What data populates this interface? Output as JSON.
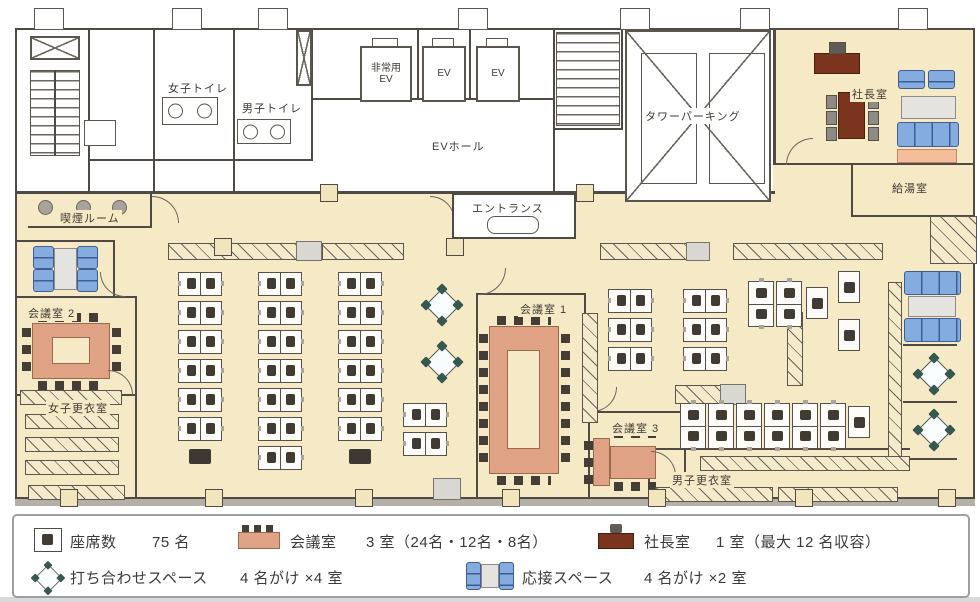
{
  "rooms": {
    "womens_toilet": "女子トイレ",
    "mens_toilet": "男子トイレ",
    "emergency_ev": "非常用EV",
    "ev1": "EV",
    "ev2": "EV",
    "ev_hall": "EVホール",
    "tower_parking": "タワーパーキング",
    "presidents_office": "社長室",
    "kitchenette": "給湯室",
    "entrance": "エントランス",
    "smoking_room": "喫煙ルーム",
    "meeting_room_1": "会議室 1",
    "meeting_room_2": "会議室 2",
    "meeting_room_3": "会議室 3",
    "womens_locker_room": "女子更衣室",
    "mens_locker_room": "男子更衣室"
  },
  "legend": {
    "seats": {
      "label": "座席数",
      "value": "75 名"
    },
    "meeting": {
      "label": "会議室",
      "value": "3 室（24名・12名・8名）"
    },
    "president": {
      "label": "社長室",
      "value": "1 室（最大 12 名収容）"
    },
    "mtg_space": {
      "label": "打ち合わせスペース",
      "value": "4 名がけ ×4 室"
    },
    "reception": {
      "label": "応接スペース",
      "value": "4 名がけ ×2 室"
    }
  },
  "colors": {
    "floor": "#F6E9C5",
    "wall": "#4F4A43",
    "meeting_table": "#E0A284",
    "president_furniture": "#7B351E",
    "sofa": "#85ACDE",
    "legend_border": "#9AA0A6"
  }
}
